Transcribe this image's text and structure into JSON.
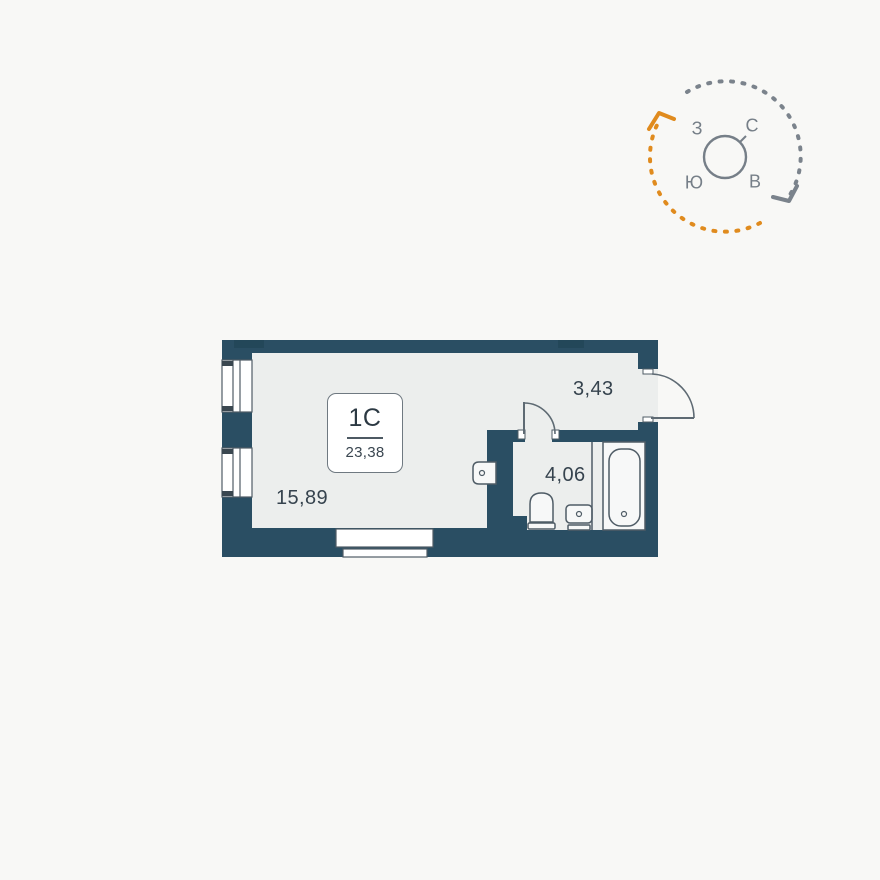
{
  "page": {
    "background": "#f8f8f6"
  },
  "plan": {
    "unit": {
      "type_label": "1С",
      "total_area": "23,38"
    },
    "areas": {
      "living_room": "15,89",
      "hallway": "3,43",
      "bathroom": "4,06"
    },
    "colors": {
      "wall": "#2a4e63",
      "floor": "#eceeed",
      "fixture_outline": "#4f5c66"
    }
  },
  "compass": {
    "letters": {
      "west": "З",
      "north": "С",
      "south": "Ю",
      "east": "В"
    },
    "colors": {
      "gray_arrow": "#7b838c",
      "orange_arrow": "#e08b1e"
    }
  }
}
